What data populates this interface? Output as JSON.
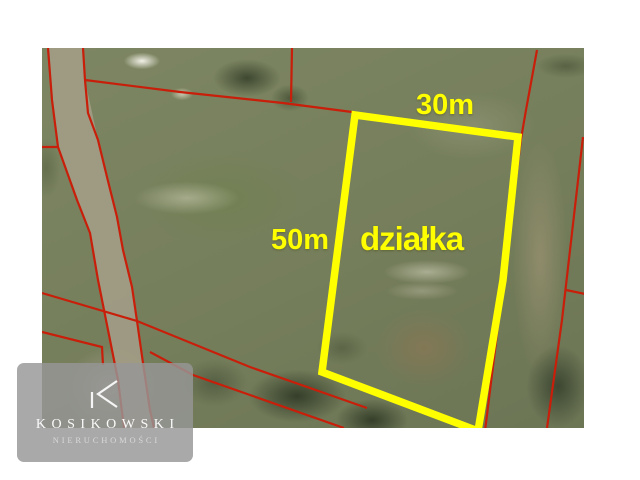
{
  "labels": {
    "top_dimension": "30m",
    "side_dimension": "50m",
    "plot": "działka"
  },
  "watermark": {
    "brand": "KOSIKOWSKI",
    "subtitle": "NIERUCHOMOŚCI"
  },
  "colors": {
    "highlight": "#ffff00",
    "parcel_line": "#c81e0a",
    "watermark_panel": "#969696",
    "photo_base": "#79825e"
  }
}
